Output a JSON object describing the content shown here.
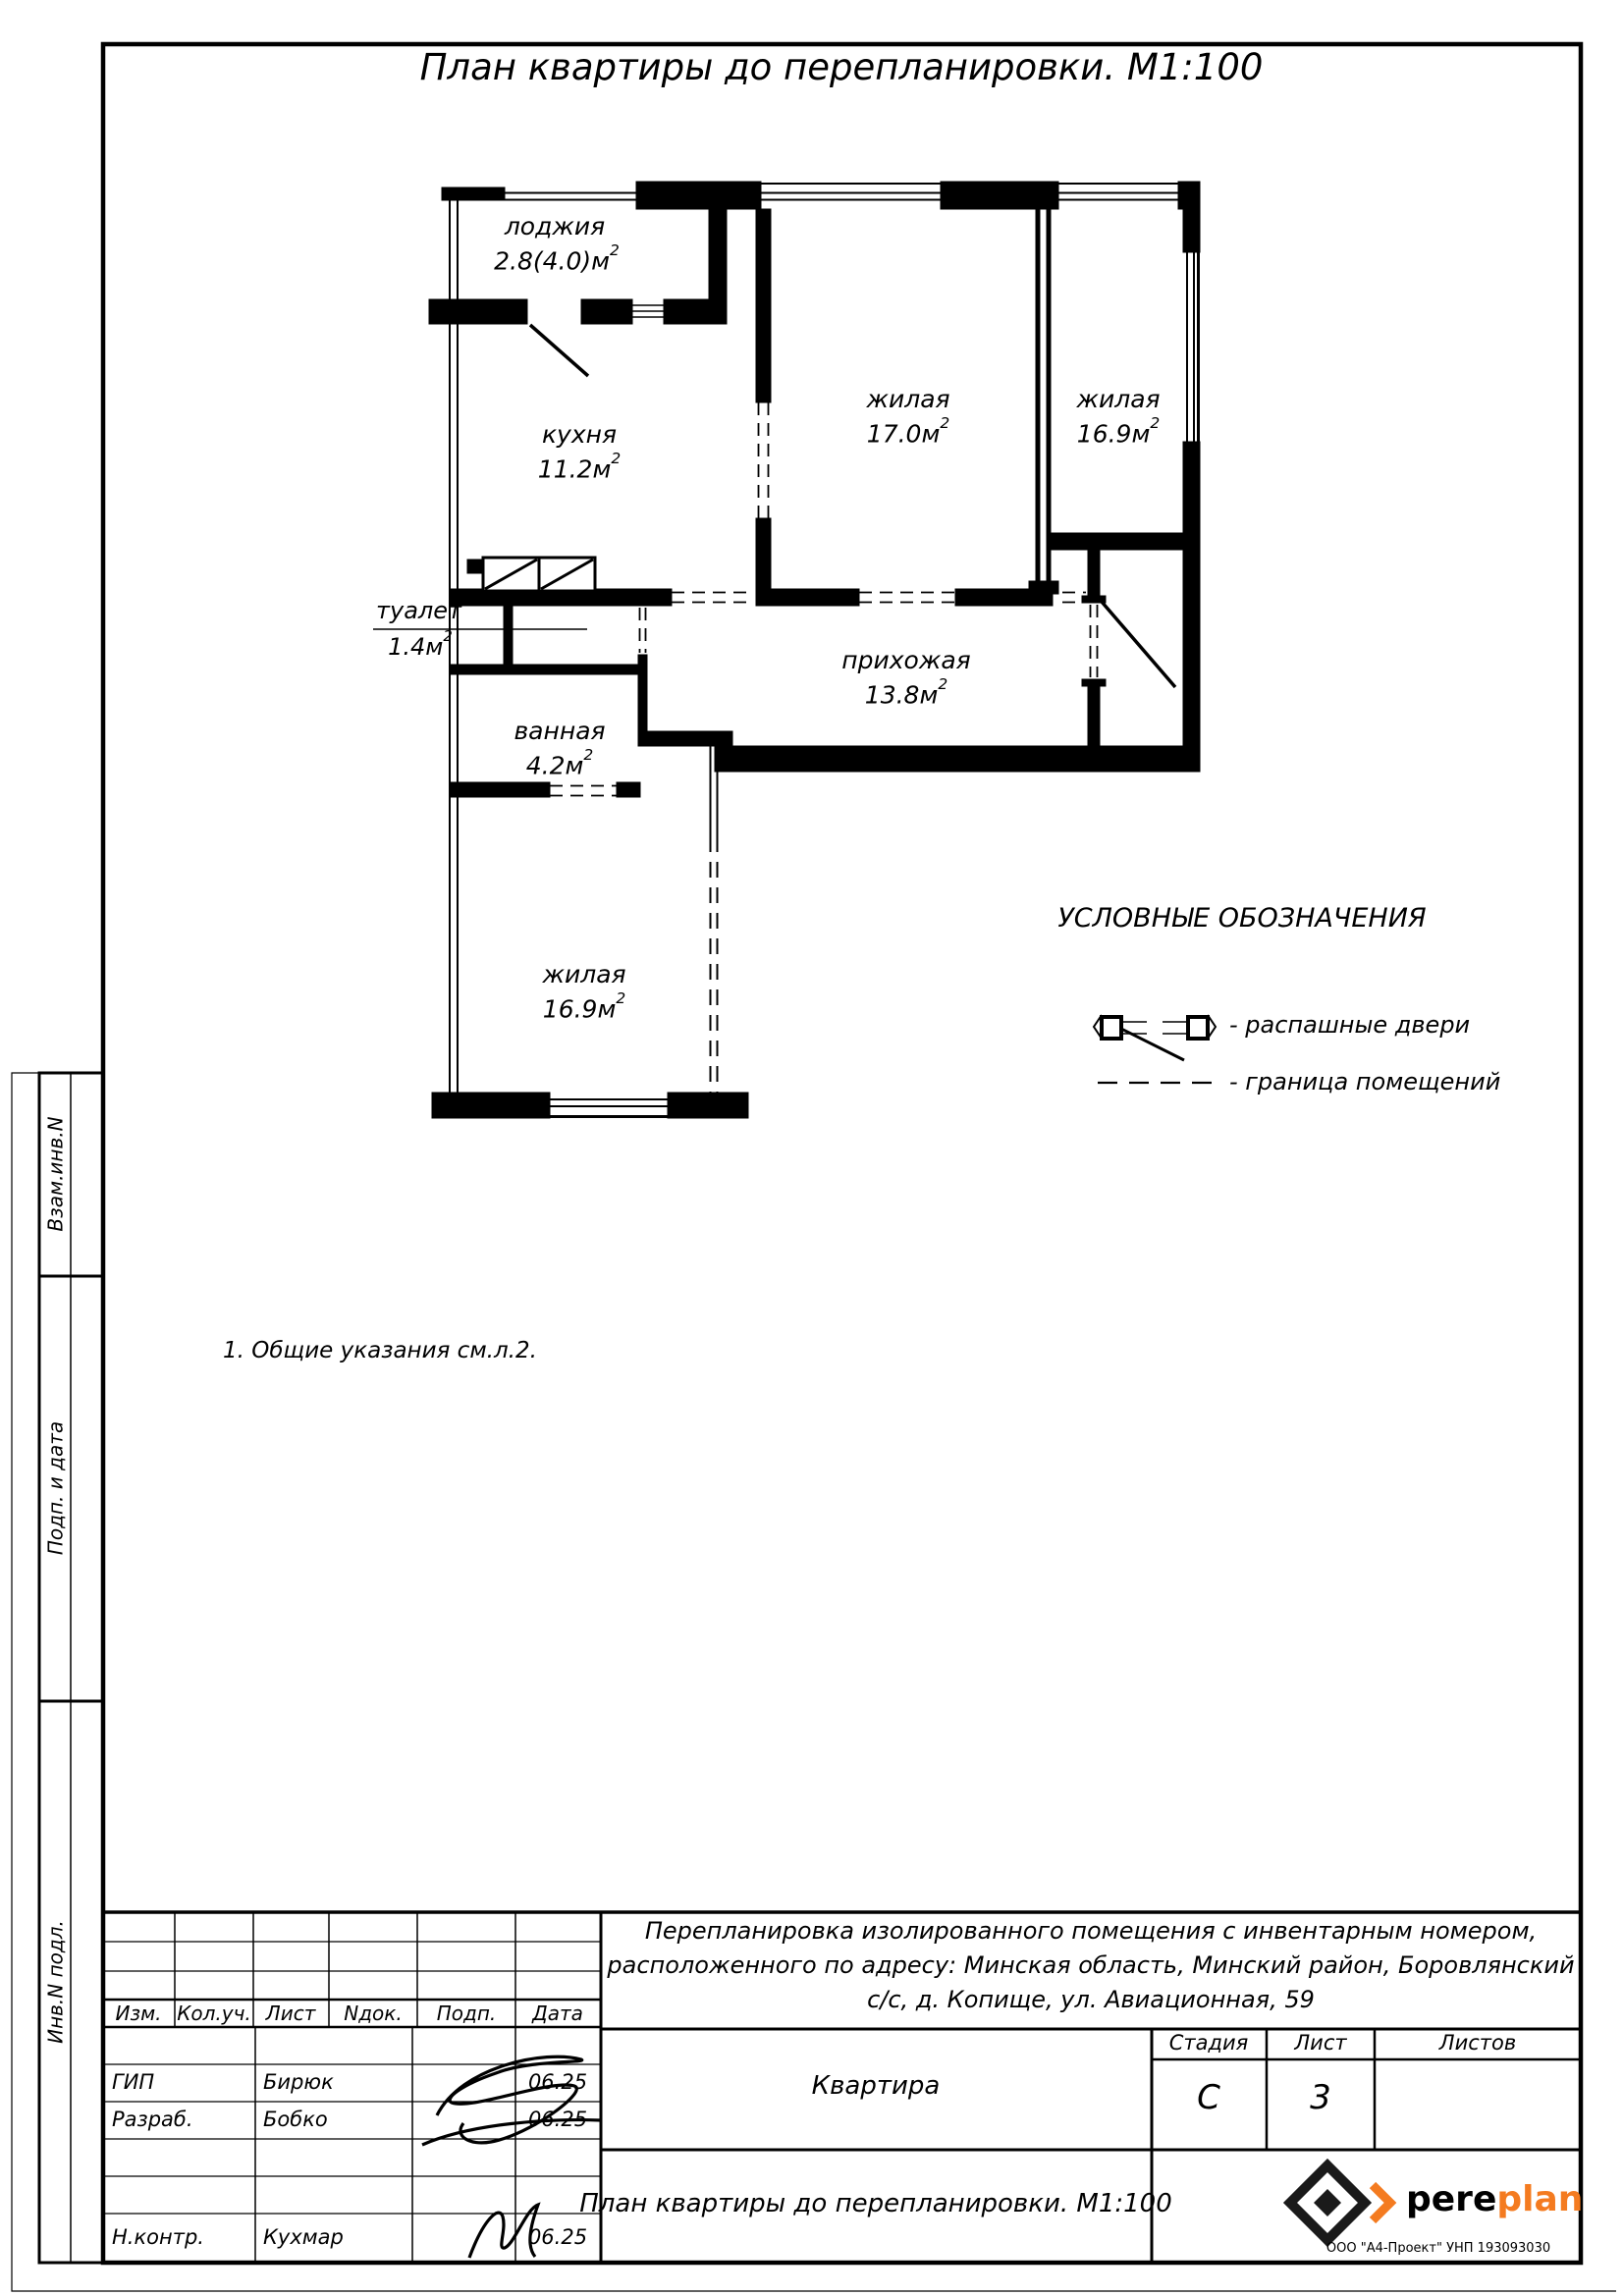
{
  "title": "План квартиры до перепланировки. М1:100",
  "note": "1. Общие указания см.л.2.",
  "sup": "2",
  "rooms": {
    "loggia": {
      "name": "лоджия",
      "area": "2.8(4.0)м"
    },
    "kitchen": {
      "name": "кухня",
      "area": "11.2м"
    },
    "living1": {
      "name": "жилая",
      "area": "17.0м"
    },
    "living2": {
      "name": "жилая",
      "area": "16.9м"
    },
    "hall": {
      "name": "прихожая",
      "area": "13.8м"
    },
    "wc": {
      "name": "туалет",
      "area": "1.4м"
    },
    "bath": {
      "name": "ванная",
      "area": "4.2м"
    },
    "living3": {
      "name": "жилая",
      "area": "16.9м"
    }
  },
  "legend": {
    "title": "УСЛОВНЫЕ ОБОЗНАЧЕНИЯ",
    "door_label": "- распашные двери",
    "boundary_label": "- граница помещений"
  },
  "sidebar": {
    "label1": "Взам.инв.N",
    "label2": "Подп. и дата",
    "label3": "Инв.N подл."
  },
  "titleblock": {
    "rev_headers": [
      "Изм.",
      "Кол.уч.",
      "Лист",
      "Nдок.",
      "Подп.",
      "Дата"
    ],
    "roles": [
      {
        "role": "ГИП",
        "name": "Бирюк",
        "date": "06.25"
      },
      {
        "role": "Разраб.",
        "name": "Бобко",
        "date": "06.25"
      },
      {
        "role": "Н.контр.",
        "name": "Кухмар",
        "date": "06.25"
      }
    ],
    "desc1": "Перепланировка изолированного помещения с инвентарным номером,",
    "desc2": "расположенного по адресу: Минская область, Минский район, Боровлянский",
    "desc3": "с/с, д. Копище, ул. Авиационная, 59",
    "object": "Квартира",
    "stage_label": "Стадия",
    "sheet_label": "Лист",
    "sheets_label": "Листов",
    "stage": "С",
    "sheet": "3",
    "drawing_title": "План квартиры до перепланировки. М1:100",
    "logo_part1": "pere",
    "logo_part2": "plan",
    "logo_sub": "ООО \"А4-Проект\" УНП 193093030"
  },
  "colors": {
    "ink": "#000000",
    "accent": "#f47b20"
  }
}
